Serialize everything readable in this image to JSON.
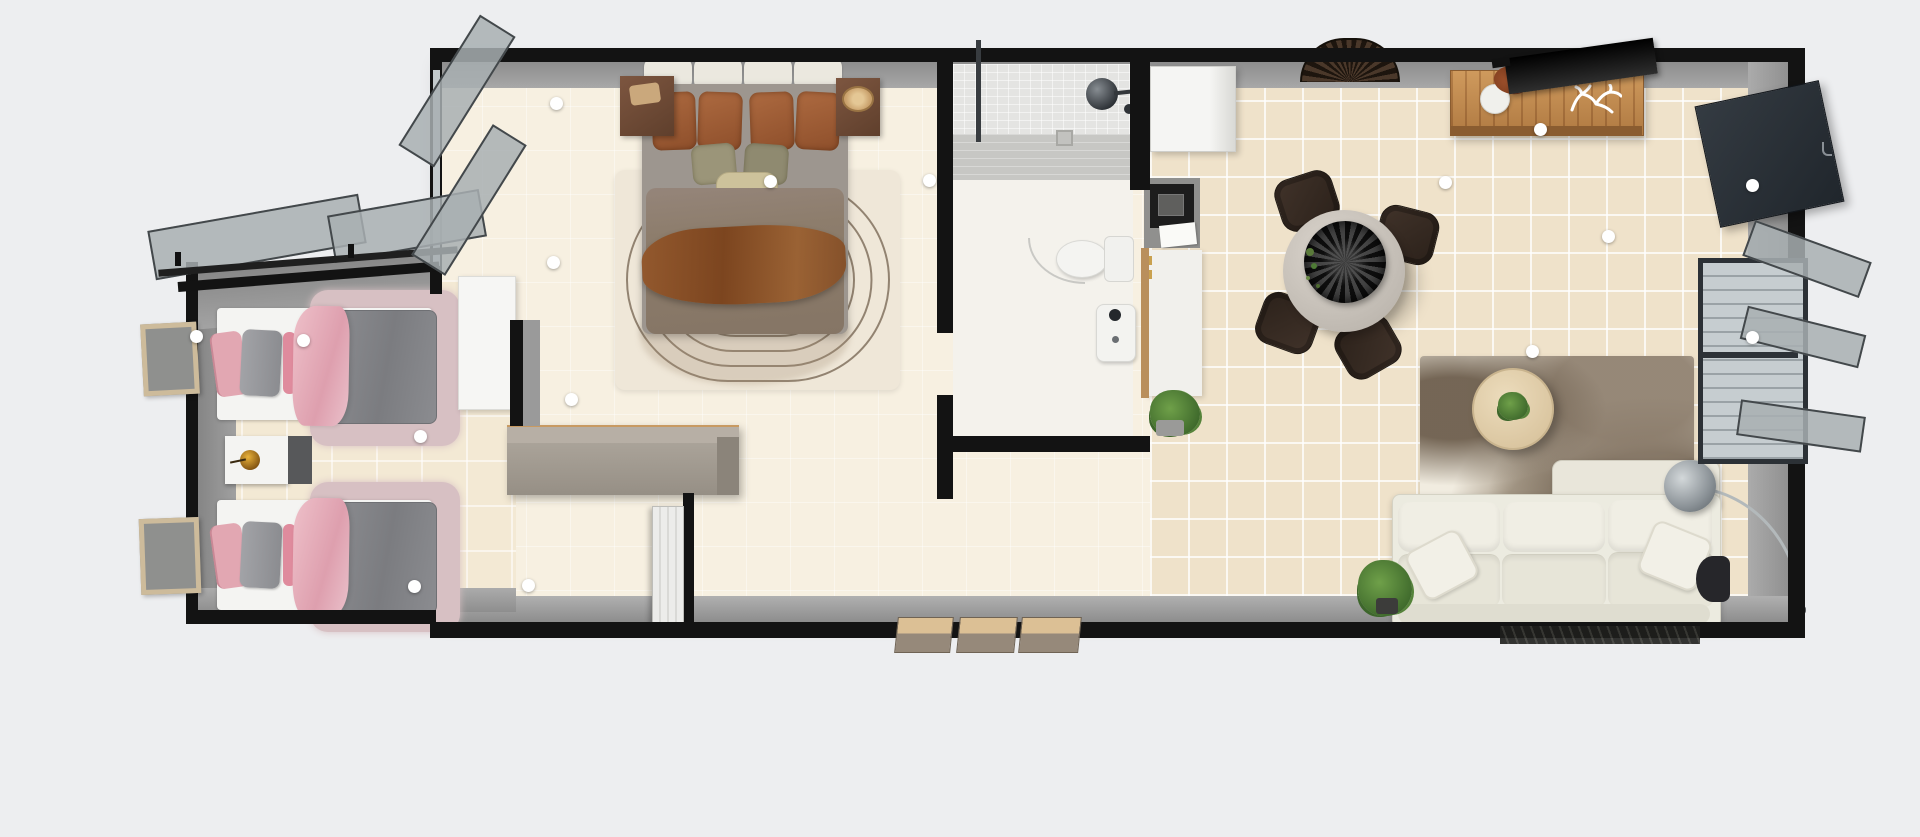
{
  "scene": {
    "view": "top-down 3D floor plan render",
    "background": "#edeef0"
  },
  "colors": {
    "bg": "#edeef0",
    "wall": "#131313",
    "wallFace": "#929292",
    "slab": "#f7f0e1",
    "tile": "#efe2ca",
    "bathFloor": "#f4f2ec",
    "showerA": "#e4e4e2",
    "showerB": "#c7c7c4",
    "pinkLight": "#e7b4be",
    "pinkDeep": "#df8b9d",
    "duvetGray": "#85868b",
    "platform": "#f4f4f2",
    "rugMauve": "#d7c0c3",
    "nightWood": "#6e4b36",
    "duvetBrown": "#8d7d6c",
    "throwRust": "#8a5531",
    "pillowRust": "#a4603a",
    "pillowOlive": "#9a947b",
    "cushionCream": "#ebe8df",
    "rugCream": "#efe7d8",
    "rugLine": "#7a6a58",
    "chairBrown": "#35291f",
    "tableTop": "#cfc9c1",
    "sideboardWood": "#c08a4f",
    "tvBlack": "#141414",
    "sofaCream": "#ecebe0",
    "lampMetal": "#aab0b3",
    "plantGreen": "#4c7a36",
    "stepTan": "#d9bd92",
    "doorWhite": "#e9e9e6",
    "cabinetGray": "#a39c92",
    "frameTan": "#cdbb9b",
    "windowFrame": "#2c3136",
    "glass": "#c3cacc",
    "handleWhite": "#ffffff"
  },
  "rooms": {
    "twin_bedroom": {
      "items": [
        "single bed x2",
        "pink-gray bedding",
        "nightstand with amber lamp",
        "wall frame x2",
        "awning window x2",
        "white dresser"
      ]
    },
    "master_bedroom": {
      "items": [
        "double bed",
        "brown bedding",
        "headboard cushions",
        "nightstand x2",
        "concentric-line rug",
        "open casement window",
        "white dresser"
      ]
    },
    "hallway": {
      "items": [
        "gray sideboard",
        "white interior door",
        "entry steps x3"
      ]
    },
    "bathroom": {
      "items": [
        "walk-in tiled shower",
        "rain shower head",
        "toilet",
        "wash basin"
      ]
    },
    "kitchen": {
      "items": [
        "refrigerator",
        "oven unit",
        "white counter",
        "potted plant"
      ]
    },
    "living_room": {
      "items": [
        "round dining table",
        "dining chair x4",
        "black pendant bowl",
        "rattan wall fan",
        "wood sideboard",
        "television",
        "vase with branches",
        "coral decor",
        "abstract area rug",
        "round coffee table",
        "three-seat sofa",
        "arc floor lamp",
        "floor plant",
        "casement window",
        "wall tv panel",
        "dark side table",
        "door mat"
      ]
    }
  },
  "handles": {
    "count": 16
  }
}
